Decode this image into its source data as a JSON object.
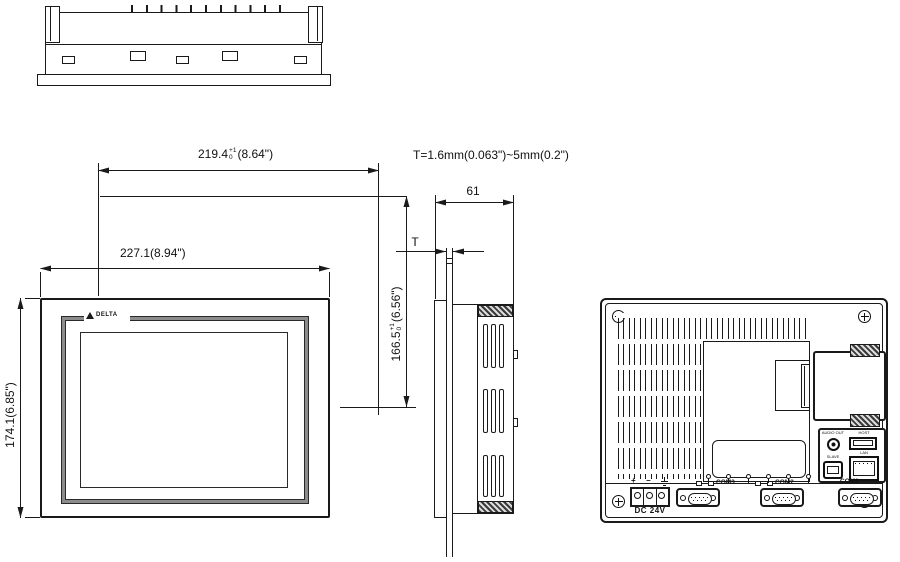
{
  "dimensions": {
    "cutout_width_mm": "219.4",
    "cutout_width_tol_upper": "+1",
    "cutout_width_tol_lower": "0",
    "cutout_width_inch": "(8.64\")",
    "bezel_width": "227.1(8.94\")",
    "bezel_height": "174.1(6.85\")",
    "cutout_height_mm": "166.5",
    "cutout_height_tol_upper": "+1",
    "cutout_height_tol_lower": "0",
    "cutout_height_inch": "(6.56\")",
    "depth": "61",
    "thickness_symbol": "T",
    "thickness_note": "T=1.6mm(0.063\")~5mm(0.2\")"
  },
  "front_view": {
    "brand": "DELTA"
  },
  "rear_view": {
    "power_plus": "+",
    "power_minus": "−",
    "power_label": "DC 24V",
    "com_ports": [
      {
        "label": "COM3"
      },
      {
        "label": "COM2"
      },
      {
        "label": "COM1"
      }
    ],
    "audio_label": "AUDIO OUT",
    "usb_host_label": "HOST",
    "usb_slave_label": "SLAVE",
    "lan_label": "LAN"
  },
  "colors": {
    "line": "#1a1a1a",
    "bezel_gray": "#8c8c8c"
  }
}
